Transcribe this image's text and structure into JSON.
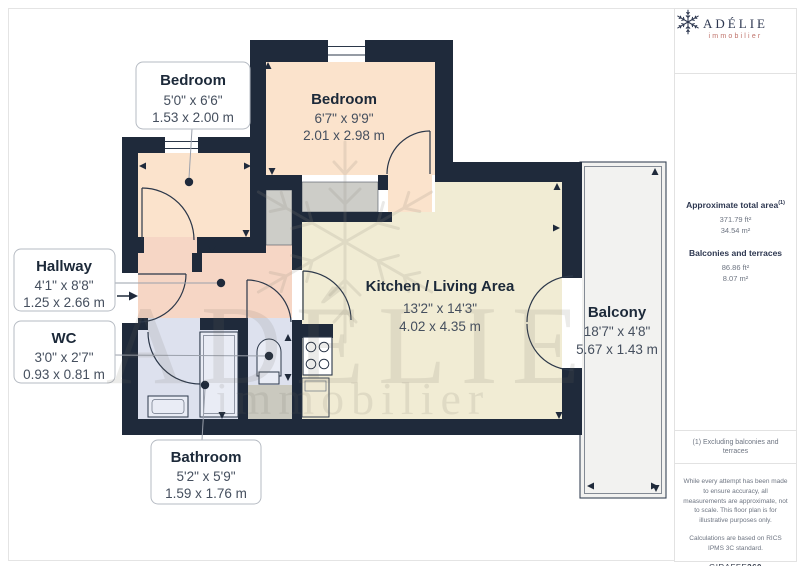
{
  "branding": {
    "name": "ADÉLIE",
    "sub": "immobilier"
  },
  "sidebar": {
    "approx_label": "Approximate total area",
    "approx_sup": "(1)",
    "approx_ft": "371.79 ft²",
    "approx_m": "34.54 m²",
    "balconies_label": "Balconies and terraces",
    "balconies_ft": "86.86 ft²",
    "balconies_m": "8.07 m²",
    "note": "(1) Excluding balconies and terraces",
    "disclaimer": "While every attempt has been made to ensure accuracy, all measurements are approximate, not to scale. This floor plan is for illustrative purposes only.",
    "standard": "Calculations are based on RICS IPMS 3C standard.",
    "brand": "GIRAFFE",
    "brand_bold": "360"
  },
  "plan": {
    "watermark": {
      "title": "ADÉLIE",
      "sub": "immobilier"
    },
    "rooms": [
      {
        "name": "Bedroom",
        "imperial": "5'0\" x 6'6\"",
        "metric": "1.53 x 2.00 m"
      },
      {
        "name": "Bedroom",
        "imperial": "6'7\" x 9'9\"",
        "metric": "2.01 x 2.98 m"
      },
      {
        "name": "Hallway",
        "imperial": "4'1\" x 8'8\"",
        "metric": "1.25 x 2.66 m"
      },
      {
        "name": "WC",
        "imperial": "3'0\" x 2'7\"",
        "metric": "0.93 x 0.81 m"
      },
      {
        "name": "Kitchen / Living Area",
        "imperial": "13'2\" x 14'3\"",
        "metric": "4.02 x 4.35 m"
      },
      {
        "name": "Balcony",
        "imperial": "18'7\" x 4'8\"",
        "metric": "5.67 x 1.43 m"
      },
      {
        "name": "Bathroom",
        "imperial": "5'2\" x 5'9\"",
        "metric": "1.59 x 1.76 m"
      }
    ],
    "colors": {
      "wall": "#1f2a3b",
      "bedroom_fill": "#fbe3cc",
      "living_fill": "#f1ecd4",
      "hallway_fill": "#f6d6c5",
      "bathroom_fill": "#dde1ee",
      "balcony_fill": "#f2f2f0",
      "logo_accent": "#bf7169"
    }
  }
}
